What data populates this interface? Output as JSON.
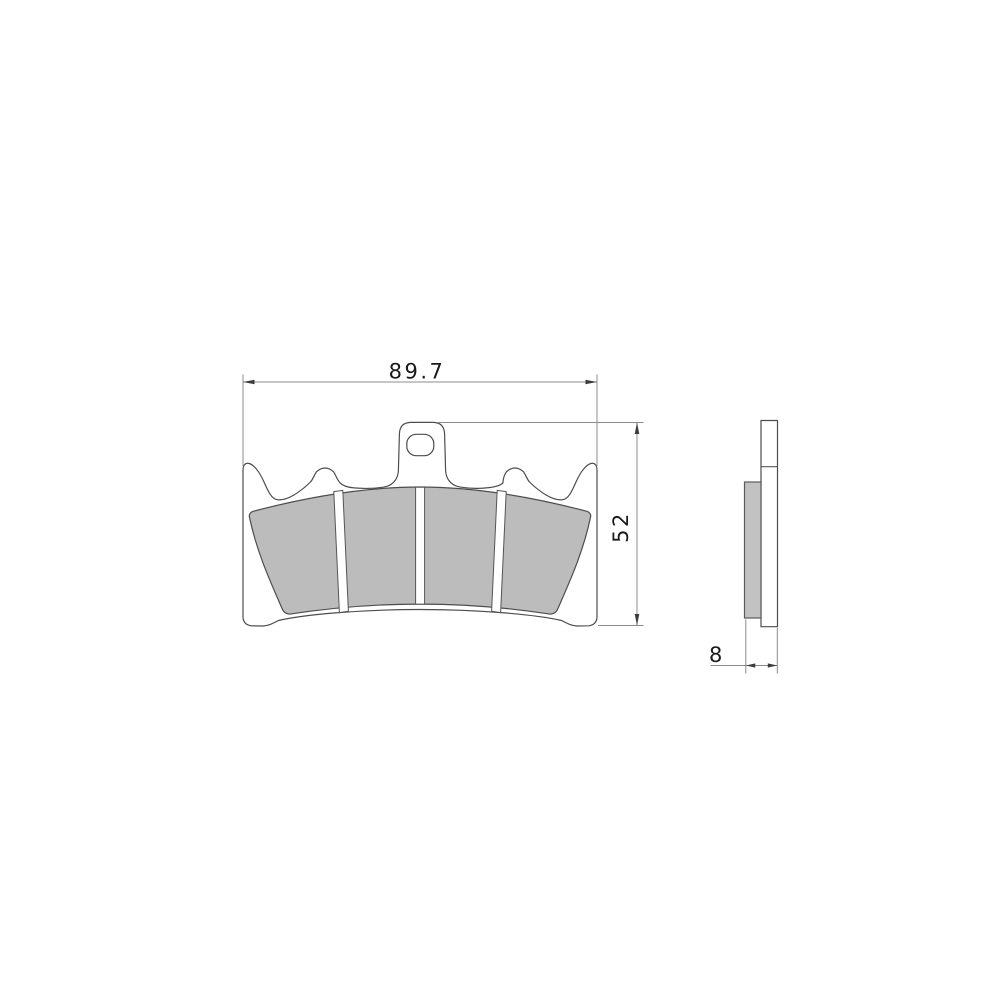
{
  "drawing": {
    "subject": "brake-pad-two-view-technical-drawing",
    "dimensions": {
      "width_mm": "89.7",
      "height_mm": "52",
      "thickness_mm": "8"
    },
    "colors": {
      "background": "#ffffff",
      "part_outline": "#4d4d4d",
      "dimension_lines": "#8c8c8c",
      "friction_material_fill": "#bcbcbc",
      "text": "#1a1a1a"
    }
  }
}
